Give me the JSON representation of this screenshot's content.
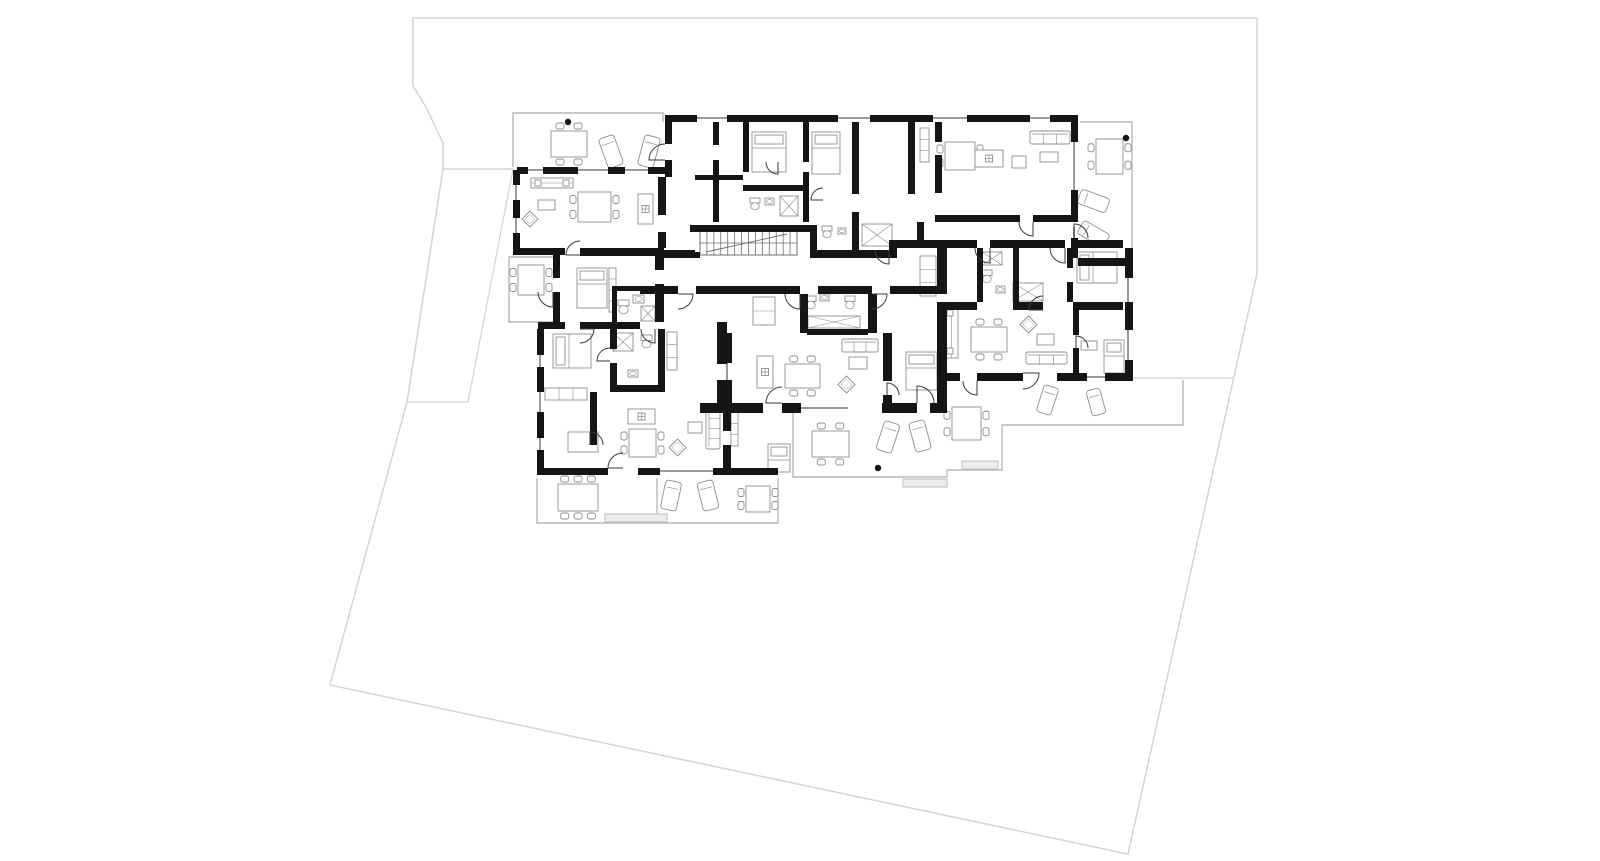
{
  "document": {
    "kind": "architectural-floor-plan"
  },
  "colors": {
    "background": "#ffffff",
    "wall": "#151515",
    "door": "#3a3a3a",
    "furniture": "#8e8e8e",
    "terrace": "#b9b9b9",
    "site_boundary": "#d2d2d2",
    "window": "#9a9a9a",
    "planter_fill": "#ececec",
    "stair": "#6f6f6f"
  },
  "canvas": {
    "width": 1600,
    "height": 861
  },
  "site": {
    "boundary": [
      [
        413,
        18
      ],
      [
        1257,
        18
      ],
      [
        1257,
        273
      ],
      [
        1128,
        854
      ],
      [
        330,
        685
      ],
      [
        407,
        402
      ],
      [
        443,
        169
      ],
      [
        443,
        143
      ],
      [
        426,
        107
      ],
      [
        413,
        86
      ]
    ],
    "driveway": [
      [
        443,
        169
      ],
      [
        513,
        169
      ],
      [
        468,
        402
      ],
      [
        407,
        402
      ]
    ],
    "lines": [
      [
        [
          443,
          169
        ],
        [
          513,
          169
        ]
      ],
      [
        [
          1133,
          378
        ],
        [
          1233,
          378
        ]
      ]
    ]
  },
  "terraces": [
    [
      [
        513,
        167
      ],
      [
        513,
        113
      ],
      [
        663,
        113
      ],
      [
        663,
        122
      ]
    ],
    [
      [
        553,
        257
      ],
      [
        509,
        257
      ],
      [
        509,
        322
      ],
      [
        553,
        322
      ]
    ],
    [
      [
        537,
        478
      ],
      [
        537,
        523
      ],
      [
        778,
        523
      ],
      [
        778,
        478
      ]
    ],
    [
      [
        657,
        478
      ],
      [
        657,
        523
      ]
    ],
    [
      [
        793,
        413
      ],
      [
        793,
        477
      ],
      [
        947,
        477
      ]
    ],
    [
      [
        947,
        477
      ],
      [
        947,
        470
      ],
      [
        1002,
        470
      ],
      [
        1002,
        425
      ],
      [
        1183,
        425
      ],
      [
        1183,
        380
      ]
    ],
    [
      [
        1080,
        122
      ],
      [
        1132,
        122
      ],
      [
        1132,
        258
      ]
    ]
  ],
  "walls": [
    [
      517,
      167,
      11,
      7
    ],
    [
      543,
      167,
      35,
      7
    ],
    [
      608,
      167,
      17,
      7
    ],
    [
      648,
      167,
      17,
      7
    ],
    [
      665,
      122,
      7,
      22
    ],
    [
      665,
      160,
      7,
      17
    ],
    [
      513,
      170,
      7,
      15
    ],
    [
      513,
      200,
      7,
      18
    ],
    [
      513,
      233,
      7,
      22
    ],
    [
      513,
      248,
      52,
      7
    ],
    [
      658,
      177,
      8,
      38
    ],
    [
      658,
      232,
      8,
      16
    ],
    [
      665,
      115,
      32,
      7
    ],
    [
      727,
      115,
      111,
      7
    ],
    [
      870,
      115,
      63,
      7
    ],
    [
      967,
      115,
      63,
      7
    ],
    [
      1050,
      115,
      28,
      7
    ],
    [
      1071,
      122,
      7,
      20
    ],
    [
      1071,
      190,
      7,
      32
    ],
    [
      1071,
      238,
      7,
      20
    ],
    [
      713,
      122,
      6,
      23
    ],
    [
      713,
      160,
      6,
      62
    ],
    [
      695,
      175,
      48,
      5
    ],
    [
      743,
      122,
      6,
      50
    ],
    [
      743,
      185,
      60,
      6
    ],
    [
      803,
      122,
      6,
      40
    ],
    [
      803,
      172,
      6,
      50
    ],
    [
      852,
      122,
      7,
      72
    ],
    [
      852,
      212,
      7,
      38
    ],
    [
      908,
      122,
      7,
      72
    ],
    [
      935,
      122,
      7,
      20
    ],
    [
      935,
      155,
      7,
      38
    ],
    [
      935,
      215,
      85,
      7
    ],
    [
      1033,
      215,
      38,
      7
    ],
    [
      917,
      222,
      7,
      18
    ],
    [
      690,
      225,
      125,
      7
    ],
    [
      810,
      225,
      7,
      33
    ],
    [
      692,
      252,
      8,
      6
    ],
    [
      655,
      250,
      40,
      8
    ],
    [
      817,
      250,
      72,
      8
    ],
    [
      889,
      240,
      8,
      18
    ],
    [
      897,
      240,
      80,
      8
    ],
    [
      990,
      240,
      75,
      8
    ],
    [
      1078,
      240,
      45,
      8
    ],
    [
      640,
      286,
      38,
      8
    ],
    [
      696,
      286,
      104,
      8
    ],
    [
      818,
      286,
      54,
      8
    ],
    [
      890,
      286,
      57,
      8
    ],
    [
      553,
      255,
      7,
      23
    ],
    [
      553,
      292,
      7,
      30
    ],
    [
      538,
      322,
      27,
      7
    ],
    [
      580,
      322,
      60,
      7
    ],
    [
      580,
      248,
      75,
      8
    ],
    [
      612,
      286,
      5,
      36
    ],
    [
      612,
      286,
      43,
      5
    ],
    [
      655,
      248,
      9,
      22
    ],
    [
      655,
      284,
      9,
      38
    ],
    [
      537,
      329,
      7,
      26
    ],
    [
      537,
      367,
      7,
      25
    ],
    [
      537,
      412,
      7,
      26
    ],
    [
      537,
      450,
      7,
      25
    ],
    [
      537,
      468,
      71,
      7
    ],
    [
      638,
      468,
      22,
      7
    ],
    [
      713,
      468,
      65,
      7
    ],
    [
      610,
      329,
      7,
      20
    ],
    [
      610,
      363,
      7,
      22
    ],
    [
      610,
      385,
      55,
      7
    ],
    [
      658,
      329,
      7,
      56
    ],
    [
      590,
      392,
      7,
      53
    ],
    [
      717,
      322,
      10,
      42
    ],
    [
      717,
      380,
      10,
      23
    ],
    [
      700,
      403,
      27,
      10
    ],
    [
      723,
      413,
      8,
      18
    ],
    [
      723,
      445,
      8,
      23
    ],
    [
      727,
      403,
      36,
      10
    ],
    [
      782,
      403,
      19,
      10
    ],
    [
      882,
      403,
      35,
      10
    ],
    [
      930,
      403,
      17,
      10
    ],
    [
      723,
      333,
      9,
      30
    ],
    [
      723,
      380,
      9,
      23
    ],
    [
      800,
      294,
      8,
      39
    ],
    [
      868,
      294,
      9,
      39
    ],
    [
      807,
      329,
      61,
      6
    ],
    [
      883,
      333,
      9,
      48
    ],
    [
      883,
      395,
      9,
      12
    ],
    [
      937,
      248,
      10,
      38
    ],
    [
      937,
      302,
      10,
      72
    ],
    [
      937,
      374,
      10,
      29
    ],
    [
      977,
      248,
      6,
      54
    ],
    [
      1013,
      248,
      6,
      54
    ],
    [
      1067,
      248,
      6,
      20
    ],
    [
      1067,
      282,
      6,
      20
    ],
    [
      943,
      302,
      34,
      8
    ],
    [
      1013,
      302,
      30,
      8
    ],
    [
      1073,
      302,
      50,
      8
    ],
    [
      1125,
      248,
      8,
      30
    ],
    [
      1125,
      302,
      8,
      28
    ],
    [
      1125,
      360,
      8,
      13
    ],
    [
      1105,
      373,
      28,
      8
    ],
    [
      1057,
      373,
      30,
      8
    ],
    [
      977,
      373,
      46,
      8
    ],
    [
      943,
      373,
      17,
      8
    ],
    [
      1073,
      310,
      6,
      25
    ],
    [
      1073,
      348,
      6,
      25
    ],
    [
      1078,
      258,
      54,
      8
    ]
  ],
  "windows": [
    [
      697,
      118,
      727,
      118
    ],
    [
      838,
      118,
      870,
      118
    ],
    [
      933,
      118,
      967,
      118
    ],
    [
      1030,
      118,
      1050,
      118
    ],
    [
      528,
      170,
      543,
      170
    ],
    [
      578,
      170,
      608,
      170
    ],
    [
      625,
      170,
      648,
      170
    ],
    [
      516,
      185,
      516,
      200
    ],
    [
      516,
      218,
      516,
      233
    ],
    [
      540,
      355,
      540,
      367
    ],
    [
      540,
      392,
      540,
      412
    ],
    [
      540,
      438,
      540,
      450
    ],
    [
      660,
      471,
      713,
      471
    ],
    [
      801,
      408,
      848,
      408
    ],
    [
      1128,
      278,
      1128,
      302
    ],
    [
      1128,
      330,
      1128,
      360
    ],
    [
      1087,
      377,
      1105,
      377
    ],
    [
      1074,
      142,
      1074,
      190
    ],
    [
      1074,
      227,
      1074,
      238
    ],
    [
      727,
      363,
      727,
      380
    ],
    [
      941,
      374,
      941,
      395
    ]
  ],
  "doors": [
    [
      665,
      160,
      16,
      180,
      270
    ],
    [
      553,
      292,
      15,
      90,
      180
    ],
    [
      580,
      329,
      14,
      0,
      90
    ],
    [
      610,
      361,
      13,
      180,
      270
    ],
    [
      590,
      445,
      13,
      270,
      360
    ],
    [
      623,
      468,
      15,
      180,
      270
    ],
    [
      678,
      294,
      15,
      0,
      90
    ],
    [
      800,
      294,
      15,
      90,
      180
    ],
    [
      872,
      294,
      15,
      0,
      90
    ],
    [
      889,
      250,
      14,
      90,
      180
    ],
    [
      782,
      403,
      16,
      180,
      270
    ],
    [
      917,
      403,
      17,
      270,
      360
    ],
    [
      887,
      395,
      12,
      270,
      360
    ],
    [
      990,
      248,
      15,
      90,
      180
    ],
    [
      1065,
      248,
      15,
      90,
      180
    ],
    [
      1043,
      310,
      14,
      180,
      270
    ],
    [
      1076,
      348,
      12,
      270,
      360
    ],
    [
      1023,
      373,
      16,
      0,
      90
    ],
    [
      977,
      381,
      14,
      90,
      180
    ],
    [
      1033,
      222,
      14,
      90,
      180
    ],
    [
      778,
      162,
      12,
      90,
      180
    ],
    [
      823,
      200,
      12,
      180,
      270
    ],
    [
      655,
      329,
      14,
      90,
      180
    ],
    [
      580,
      255,
      14,
      180,
      270
    ],
    [
      1074,
      238,
      14,
      270,
      360
    ]
  ],
  "stairs": {
    "x": 700,
    "y": 231,
    "w": 97,
    "h": 24,
    "steps": 14
  },
  "dots": [
    [
      568,
      122
    ],
    [
      878,
      468
    ],
    [
      1126,
      138
    ]
  ],
  "furniture": [
    [
      "dining",
      551,
      131,
      36,
      26,
      0
    ],
    [
      "lounge",
      603,
      136,
      16,
      31,
      -20
    ],
    [
      "lounge",
      641,
      136,
      16,
      31,
      15
    ],
    [
      "counter",
      531,
      178,
      42,
      10,
      0
    ],
    [
      "side",
      538,
      200,
      17,
      10,
      0
    ],
    [
      "diamond",
      522,
      211,
      16,
      16,
      0
    ],
    [
      "dining",
      578,
      192,
      33,
      30,
      90
    ],
    [
      "island",
      638,
      194,
      15,
      30,
      0
    ],
    [
      "dining",
      518,
      265,
      26,
      30,
      90
    ],
    [
      "bed",
      577,
      268,
      30,
      40,
      0
    ],
    [
      "shelf",
      609,
      268,
      7,
      44,
      0
    ],
    [
      "wc",
      618,
      300,
      11,
      13,
      0
    ],
    [
      "sink",
      633,
      295,
      11,
      8,
      0
    ],
    [
      "shower",
      641,
      306,
      14,
      15,
      0
    ],
    [
      "bed",
      553,
      334,
      38,
      34,
      0
    ],
    [
      "shelf",
      545,
      388,
      42,
      12,
      0
    ],
    [
      "table",
      568,
      432,
      30,
      20,
      0
    ],
    [
      "island",
      628,
      409,
      27,
      15,
      0
    ],
    [
      "dining",
      629,
      429,
      27,
      28,
      90
    ],
    [
      "diamond",
      669,
      439,
      17,
      17,
      0
    ],
    [
      "side",
      688,
      422,
      14,
      11,
      0
    ],
    [
      "sofa",
      706,
      408,
      14,
      41,
      0
    ],
    [
      "shower",
      613,
      333,
      20,
      18,
      0
    ],
    [
      "wc",
      641,
      335,
      11,
      12,
      0
    ],
    [
      "sink",
      628,
      370,
      10,
      7,
      0
    ],
    [
      "shelf",
      667,
      332,
      10,
      38,
      0
    ],
    [
      "bed",
      768,
      444,
      22,
      28,
      0
    ],
    [
      "shelf",
      731,
      412,
      7,
      34,
      0
    ],
    [
      "dining",
      558,
      484,
      40,
      27,
      0
    ],
    [
      "planter",
      605,
      514,
      62,
      8,
      0
    ],
    [
      "lounge",
      663,
      481,
      16,
      29,
      12
    ],
    [
      "lounge",
      700,
      481,
      16,
      29,
      -14
    ],
    [
      "dining",
      746,
      486,
      24,
      26,
      90
    ],
    [
      "dining",
      812,
      431,
      37,
      26,
      0
    ],
    [
      "lounge",
      880,
      422,
      16,
      30,
      18
    ],
    [
      "lounge",
      912,
      421,
      16,
      30,
      -15
    ],
    [
      "dining",
      952,
      407,
      29,
      33,
      90
    ],
    [
      "planter",
      962,
      461,
      36,
      8,
      0
    ],
    [
      "planter",
      903,
      479,
      44,
      8,
      0
    ],
    [
      "island",
      757,
      356,
      16,
      32,
      0
    ],
    [
      "dining",
      785,
      364,
      35,
      24,
      0
    ],
    [
      "sofa",
      842,
      339,
      36,
      13,
      0
    ],
    [
      "coffee",
      849,
      357,
      18,
      12,
      0
    ],
    [
      "diamond",
      838,
      376,
      17,
      17,
      0
    ],
    [
      "bed",
      906,
      352,
      31,
      38,
      0
    ],
    [
      "shelf",
      753,
      297,
      22,
      28,
      0
    ],
    [
      "wc",
      806,
      296,
      10,
      12,
      0
    ],
    [
      "sink",
      820,
      294,
      9,
      7,
      0
    ],
    [
      "wc",
      845,
      296,
      10,
      12,
      0
    ],
    [
      "ward",
      808,
      316,
      52,
      12,
      0
    ],
    [
      "bed",
      752,
      132,
      34,
      40,
      0
    ],
    [
      "bed",
      812,
      132,
      28,
      42,
      0
    ],
    [
      "wc",
      750,
      198,
      10,
      11,
      0
    ],
    [
      "sink",
      765,
      198,
      9,
      7,
      0
    ],
    [
      "shower",
      780,
      196,
      18,
      20,
      0
    ],
    [
      "wc",
      822,
      226,
      10,
      11,
      0
    ],
    [
      "sink",
      838,
      228,
      8,
      6,
      0
    ],
    [
      "ward",
      862,
      224,
      30,
      22,
      0
    ],
    [
      "dining",
      945,
      142,
      30,
      28,
      90
    ],
    [
      "island",
      975,
      150,
      28,
      17,
      0
    ],
    [
      "sofa",
      1030,
      131,
      40,
      13,
      0
    ],
    [
      "side",
      1040,
      152,
      18,
      10,
      0
    ],
    [
      "coffee",
      1012,
      156,
      14,
      12,
      0
    ],
    [
      "shelf",
      920,
      128,
      9,
      34,
      0
    ],
    [
      "dining",
      1096,
      139,
      27,
      35,
      90
    ],
    [
      "lounge",
      1086,
      186,
      15,
      30,
      -70
    ],
    [
      "lounge",
      1086,
      219,
      15,
      30,
      -60
    ],
    [
      "bed",
      1077,
      252,
      40,
      31,
      0
    ],
    [
      "ward",
      982,
      252,
      20,
      13,
      0
    ],
    [
      "ward",
      1013,
      283,
      30,
      18,
      0
    ],
    [
      "wc",
      982,
      270,
      10,
      12,
      0
    ],
    [
      "sink",
      996,
      286,
      9,
      7,
      0
    ],
    [
      "shelf",
      920,
      256,
      16,
      40,
      0
    ],
    [
      "counter",
      945,
      306,
      13,
      52,
      0
    ],
    [
      "dining",
      971,
      327,
      36,
      25,
      0
    ],
    [
      "diamond",
      1020,
      316,
      17,
      17,
      0
    ],
    [
      "coffee",
      1037,
      334,
      17,
      11,
      0
    ],
    [
      "sofa",
      1026,
      352,
      41,
      12,
      0
    ],
    [
      "bed",
      1104,
      340,
      20,
      33,
      0
    ],
    [
      "side",
      1081,
      341,
      16,
      9,
      0
    ],
    [
      "lounge",
      1040,
      386,
      15,
      28,
      18
    ],
    [
      "lounge",
      1089,
      389,
      14,
      26,
      -15
    ]
  ]
}
